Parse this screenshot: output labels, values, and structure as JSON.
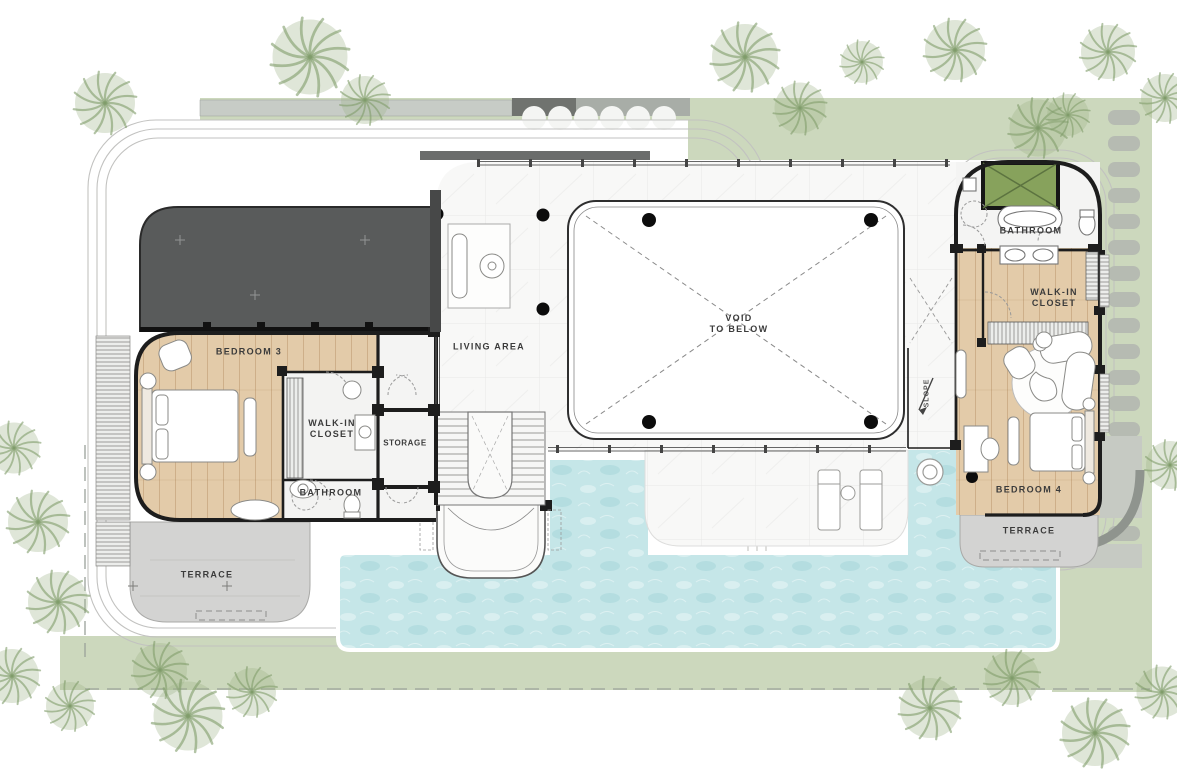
{
  "plan": {
    "rooms": {
      "bedroom_3": "BEDROOM 3",
      "walk_in_closet_left": "WALK-IN\nCLOSET",
      "bathroom_left": "BATHROOM",
      "storage": "STORAGE",
      "living_area": "LIVING AREA",
      "void": "VOID\nTO BELOW",
      "bathroom_right": "BATHROOM",
      "walk_in_closet_right": "WALK-IN\nCLOSET",
      "bedroom_4": "BEDROOM 4",
      "terrace_left": "TERRACE",
      "terrace_right": "TERRACE",
      "slope": "SLOPE"
    }
  },
  "colors": {
    "c-roof": "#595b5b",
    "c-wood": "#e3cba9",
    "c-marble": "#f8f8f7",
    "c-pool": "#c5e6e8",
    "c-garden": "#ccd8bd",
    "c-terrace": "#d3d3d2",
    "c-stone": "#b6bbb2",
    "c-skylight": "#87a25c",
    "c-wall": "#1d1d1d",
    "c-path": "#c6cac3",
    "c-label": "#3b3b3b"
  }
}
